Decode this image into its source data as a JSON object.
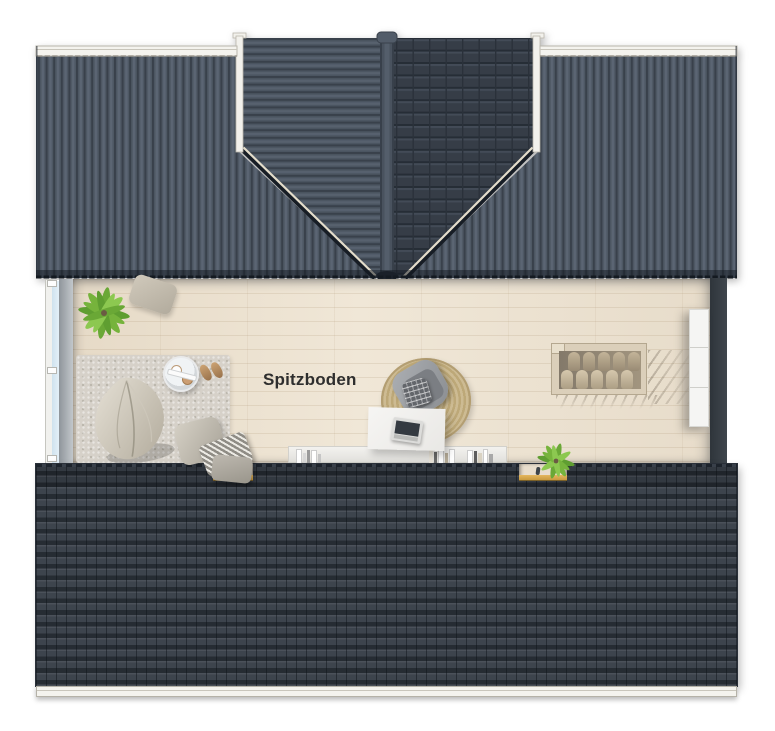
{
  "room": {
    "label": "Spitzboden"
  },
  "colors": {
    "roof_metal": "#4e5864",
    "roof_metal_dark": "#39414b",
    "roof_gable_tiles": "#363d47",
    "roof_bottom": "#3d444d",
    "gutter": "#f4f3ee",
    "floor_wood": "#e9decd",
    "rug": "#d6d1c9",
    "round_rug": "#bda878",
    "accent_sill": "#c99a3f",
    "window_glass": "#cfe2ee",
    "wall_dark": "#3f464d",
    "wall_light": "#c2c7cb",
    "cabinet": "#f5f5f3",
    "stairs_wood": "#dbcfba",
    "plant_green": "#76b33c",
    "label_text": "#2e2e2e"
  }
}
